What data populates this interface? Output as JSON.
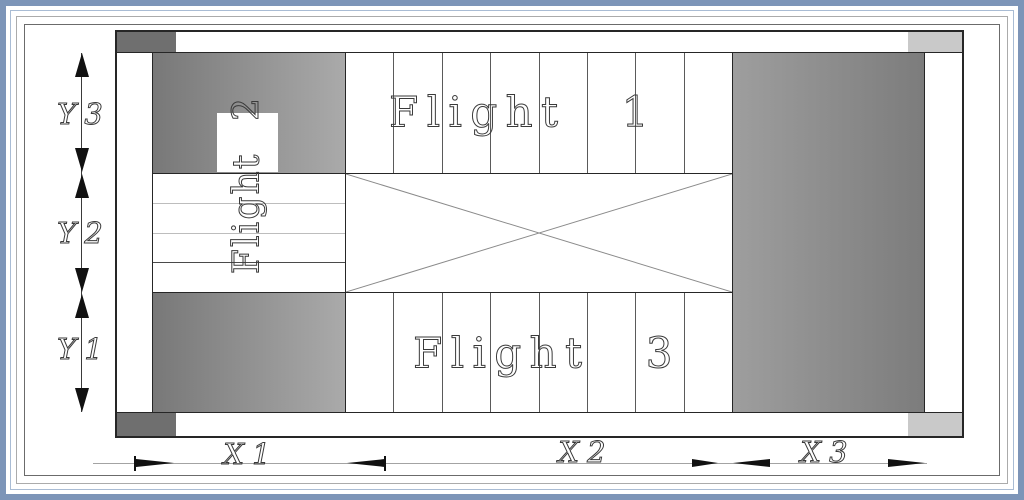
{
  "drawing": {
    "kind": "staircase-plan",
    "flights": {
      "top": "Flight 1",
      "left": "Flight 2",
      "bottom": "Flight 3"
    },
    "treads": {
      "flight1": 8,
      "flight2": 4,
      "flight3": 8
    },
    "dims_x": {
      "x1": "X1",
      "x2": "X2",
      "x3": "X3"
    },
    "dims_y": {
      "y1": "Y1",
      "y2": "Y2",
      "y3": "Y3"
    },
    "colors": {
      "frame_blue": "#7d95b8",
      "frame_line_light": "#a9bcd4",
      "frame_line_gray": "#ababab",
      "frame_line_dark": "#6b6b6b",
      "wall_corner_dark": "#6f6f6f",
      "wall_corner_light": "#c9c9c9",
      "wall_gradient_dark": "#787878",
      "wall_gradient_light": "#aaaaaa",
      "drawing_line": "#262626",
      "tread_line": "#5a5a5a",
      "tread_line_light": "#bdbdbd",
      "dim_line_x": "#a3a3a3",
      "dim_line_y": "#3a3a3a",
      "arrow": "#111111",
      "text": "#3a3a3a"
    }
  }
}
